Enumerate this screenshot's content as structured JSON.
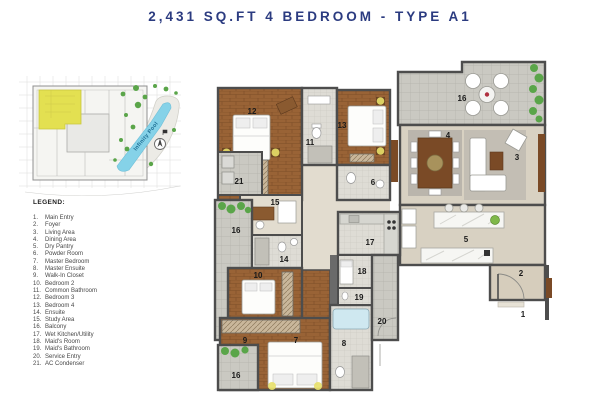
{
  "title": "2,431 SQ.FT 4 BEDROOM - TYPE A1",
  "key_plan": {
    "pool_label": "Infinity Pool",
    "highlight_color": "#e3e051",
    "pool_color": "#85d2e8",
    "plant_color": "#5aa549"
  },
  "legend": {
    "heading": "LEGEND:",
    "items": [
      {
        "num": "1.",
        "label": "Main Entry"
      },
      {
        "num": "2.",
        "label": "Foyer"
      },
      {
        "num": "3.",
        "label": "Living Area"
      },
      {
        "num": "4.",
        "label": "Dining Area"
      },
      {
        "num": "5.",
        "label": "Dry Pantry"
      },
      {
        "num": "6.",
        "label": "Powder Room"
      },
      {
        "num": "7.",
        "label": "Master Bedroom"
      },
      {
        "num": "8.",
        "label": "Master Ensuite"
      },
      {
        "num": "9.",
        "label": "Walk-In Closet"
      },
      {
        "num": "10.",
        "label": "Bedroom 2"
      },
      {
        "num": "11.",
        "label": "Common Bathroom"
      },
      {
        "num": "12.",
        "label": "Bedroom 3"
      },
      {
        "num": "13.",
        "label": "Bedroom 4"
      },
      {
        "num": "14.",
        "label": "Ensuite"
      },
      {
        "num": "15.",
        "label": "Study Area"
      },
      {
        "num": "16.",
        "label": "Balcony"
      },
      {
        "num": "17.",
        "label": "Wet Kitchen/Utility"
      },
      {
        "num": "18.",
        "label": "Maid's Room"
      },
      {
        "num": "19.",
        "label": "Maid's Bathroom"
      },
      {
        "num": "20.",
        "label": "Service Entry"
      },
      {
        "num": "21.",
        "label": "AC Condenser"
      }
    ]
  },
  "plan": {
    "room_numbers": {
      "bedroom3": "12",
      "common_bathroom": "11",
      "bedroom4": "13",
      "powder_room": "6",
      "balcony_top": "16",
      "dining": "4",
      "living": "3",
      "dry_pantry": "5",
      "foyer": "2",
      "main_entry": "1",
      "ac_condenser": "21",
      "study": "15",
      "balcony_left": "16",
      "ensuite": "14",
      "bedroom2": "10",
      "walk_in_closet": "9",
      "master_bedroom": "7",
      "balcony_bottom": "16",
      "master_ensuite": "8",
      "wet_kitchen": "17",
      "maid_room": "18",
      "maid_bath": "19",
      "service_entry": "20"
    },
    "colors": {
      "title_navy": "#2b3b80",
      "wall": "#4d4d4d",
      "wood_floor": "#996336",
      "beige_floor": "#d8d1c2",
      "balcony_tile": "#cac9c2"
    }
  }
}
